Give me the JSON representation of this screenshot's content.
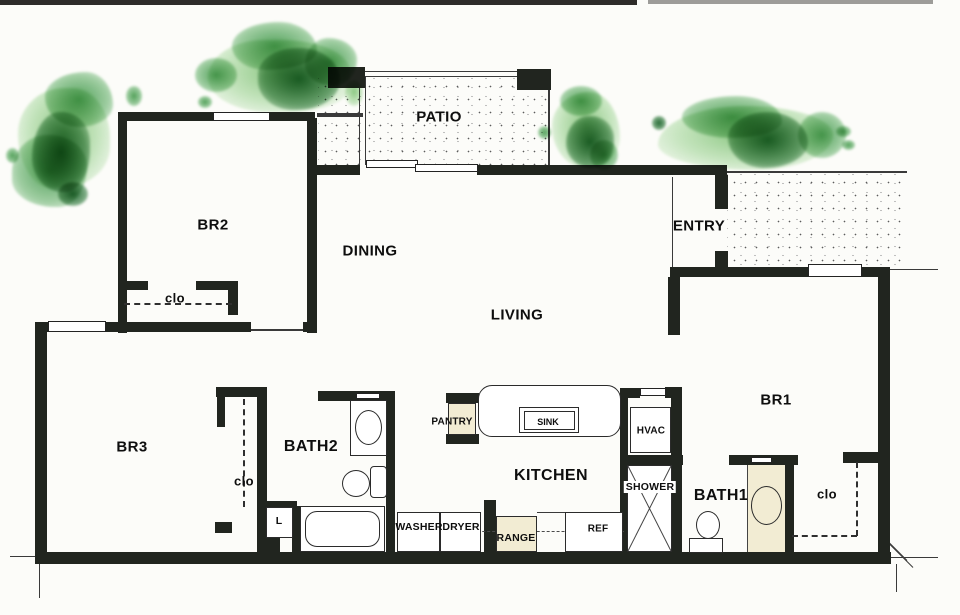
{
  "labels": {
    "patio": "PATIO",
    "br2": "BR2",
    "dining": "DINING",
    "entry": "ENTRY",
    "living": "LIVING",
    "br3": "BR3",
    "br1": "BR1",
    "kitchen": "KITCHEN",
    "bath2": "BATH2",
    "bath1": "BATH1",
    "clo_br2": "clo",
    "clo_br3": "clo",
    "clo_br1": "clo",
    "linen": "L",
    "pantry": "PANTRY",
    "sink": "SINK",
    "hvac": "HVAC",
    "shower": "SHOWER",
    "washer": "WASHER",
    "dryer": "DRYER",
    "range": "RANGE",
    "ref": "REF"
  },
  "colors": {
    "wall": "#21251f",
    "appliance_fill": "#f2ecd3",
    "tree_light": "#96d28c",
    "tree_mid": "#54aa5c",
    "tree_dark": "#1c652c",
    "stipple_dot": "#5c5c5c",
    "paper": "#fcfcf9"
  }
}
